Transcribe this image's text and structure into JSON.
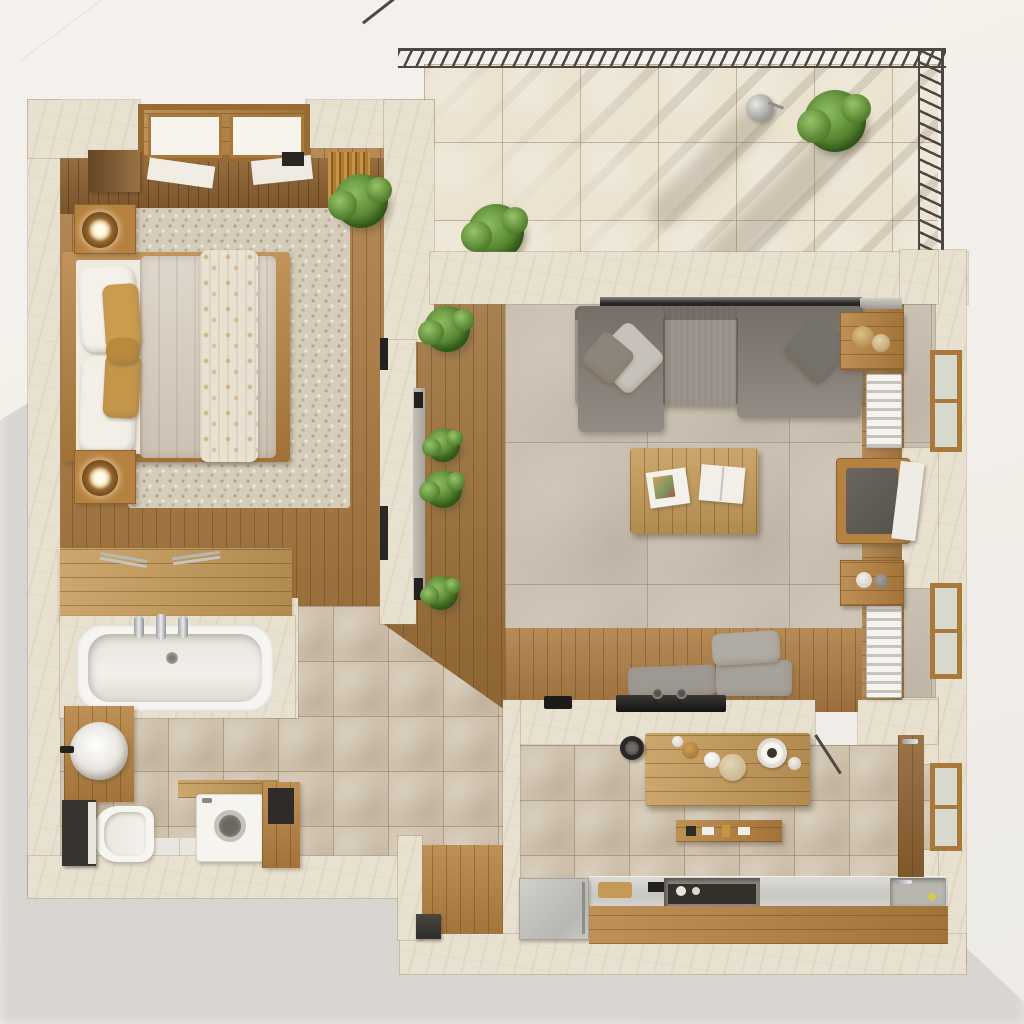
{
  "meta": {
    "title": "Apartment floor plan — top-down 3D render",
    "view": "top-down orthographic",
    "style": "photorealistic architectural visualization"
  },
  "palette": {
    "background": "#f3efea",
    "cast_shadow": "#dbd7d3",
    "wall_marble": "#e9e1d0",
    "wood_mid": "#ac7b41",
    "wood_dark": "#8e6130",
    "wood_light": "#c59a58",
    "tile_beige": "#cfc2ad",
    "tile_cream": "#ebe2cf",
    "tile_stone": "#cac0b1",
    "sofa_gray": "#8a8279",
    "accent_gold": "#c99c4e",
    "plant_green": "#55832f",
    "railing_metal": "#4c4742",
    "fixture_white": "#f6f4ef"
  },
  "rooms": {
    "bedroom": {
      "label": "Bedroom",
      "furniture": [
        "double bed with beige duvet and patterned throw",
        "white and gold pillows",
        "two wooden nightstands",
        "round table lamps",
        "pebble-stone rug",
        "pergola skylight",
        "dark wardrobe",
        "hanging plant"
      ]
    },
    "balcony": {
      "label": "Balcony terrace",
      "furniture": [
        "dark metal railing",
        "cream floor tiles",
        "two potted plants",
        "watering can",
        "wooden planter bench",
        "pergola shadow stripes"
      ]
    },
    "living_room": {
      "label": "Living room",
      "furniture": [
        "gray sectional sofa with throw pillows",
        "wooden coffee table with magazines",
        "wooden side tables",
        "armchair with dark cushion",
        "white radiators",
        "wood-framed windows",
        "window bench with gray cushions",
        "black TV console"
      ]
    },
    "kitchen_dining": {
      "label": "Kitchen and dining",
      "furniture": [
        "wooden dining table with tableware",
        "black pendant lamp",
        "floating shelf",
        "kitchen counter with cooktop and sink",
        "silver fridge",
        "wooden cabinet fronts",
        "pantry door",
        "door swing"
      ]
    },
    "bathroom": {
      "label": "Bathroom",
      "furniture": [
        "bathtub with chrome taps",
        "wooden counter with towel rails",
        "round basin on wood vanity",
        "wall-hung toilet",
        "dark storage cabinet",
        "washing machine",
        "wooden side cabinet"
      ]
    },
    "hallway": {
      "label": "Hallway deck",
      "furniture": [
        "wooden walkway",
        "four potted plants",
        "sliding glass door"
      ]
    },
    "entry": {
      "label": "Entry nook",
      "furniture": [
        "wood plank floor",
        "dark storage box"
      ]
    }
  }
}
